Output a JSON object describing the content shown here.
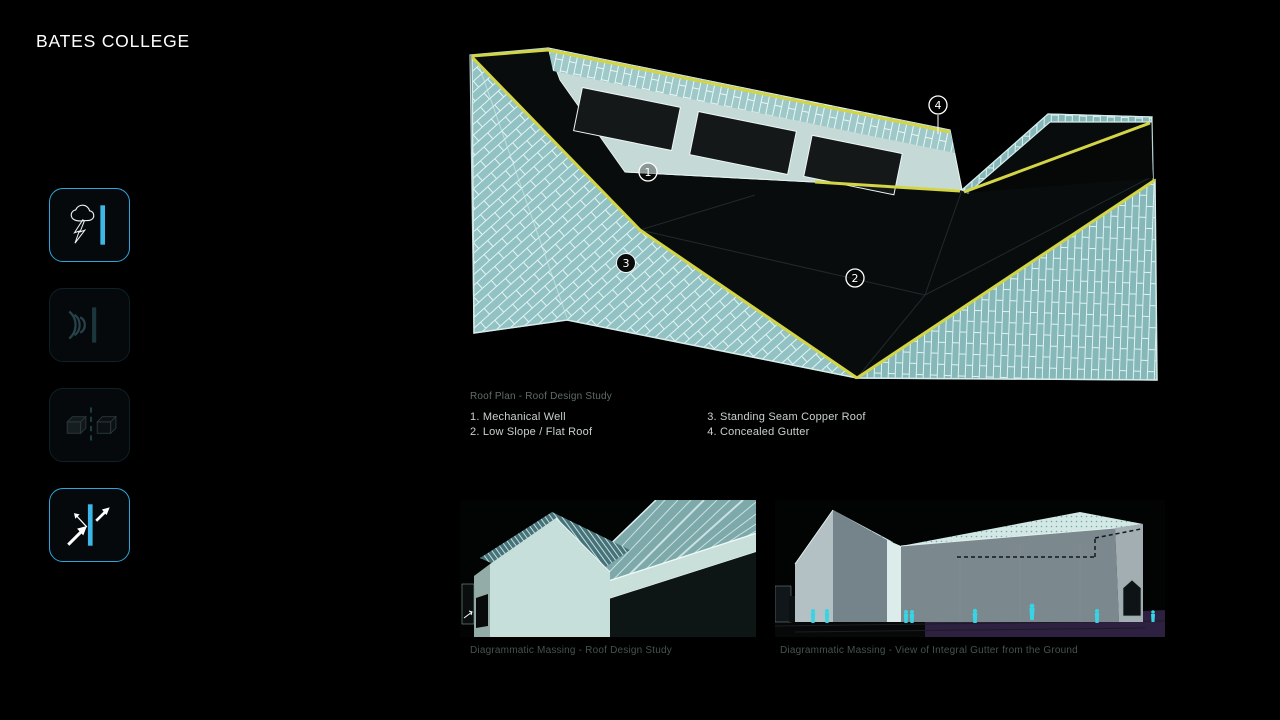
{
  "app": {
    "title": "BATES COLLEGE"
  },
  "colors": {
    "background": "#000000",
    "accent_blue": "#3db7e8",
    "edge_yellow": "#d3d545",
    "copper_teal": "#93c2c4",
    "legend_text": "#c8d2cd",
    "caption_text": "#5e6d68",
    "figure_cyan": "#39d4e4"
  },
  "sidebar": {
    "items": [
      {
        "name": "storm-lightning",
        "active": true
      },
      {
        "name": "sound-waves",
        "active": false
      },
      {
        "name": "massing-cubes",
        "active": false
      },
      {
        "name": "reflection-arrows",
        "active": true
      }
    ]
  },
  "roof_plan": {
    "caption": "Roof Plan - Roof Design Study",
    "callouts": [
      "1",
      "2",
      "3",
      "4"
    ],
    "legend": [
      "1. Mechanical Well",
      "2. Low Slope / Flat Roof",
      "3. Standing Seam Copper Roof",
      "4. Concealed Gutter"
    ]
  },
  "massing": {
    "left_caption": "Diagrammatic Massing - Roof Design Study",
    "right_caption": "Diagrammatic Massing - View of Integral Gutter from the Ground"
  }
}
